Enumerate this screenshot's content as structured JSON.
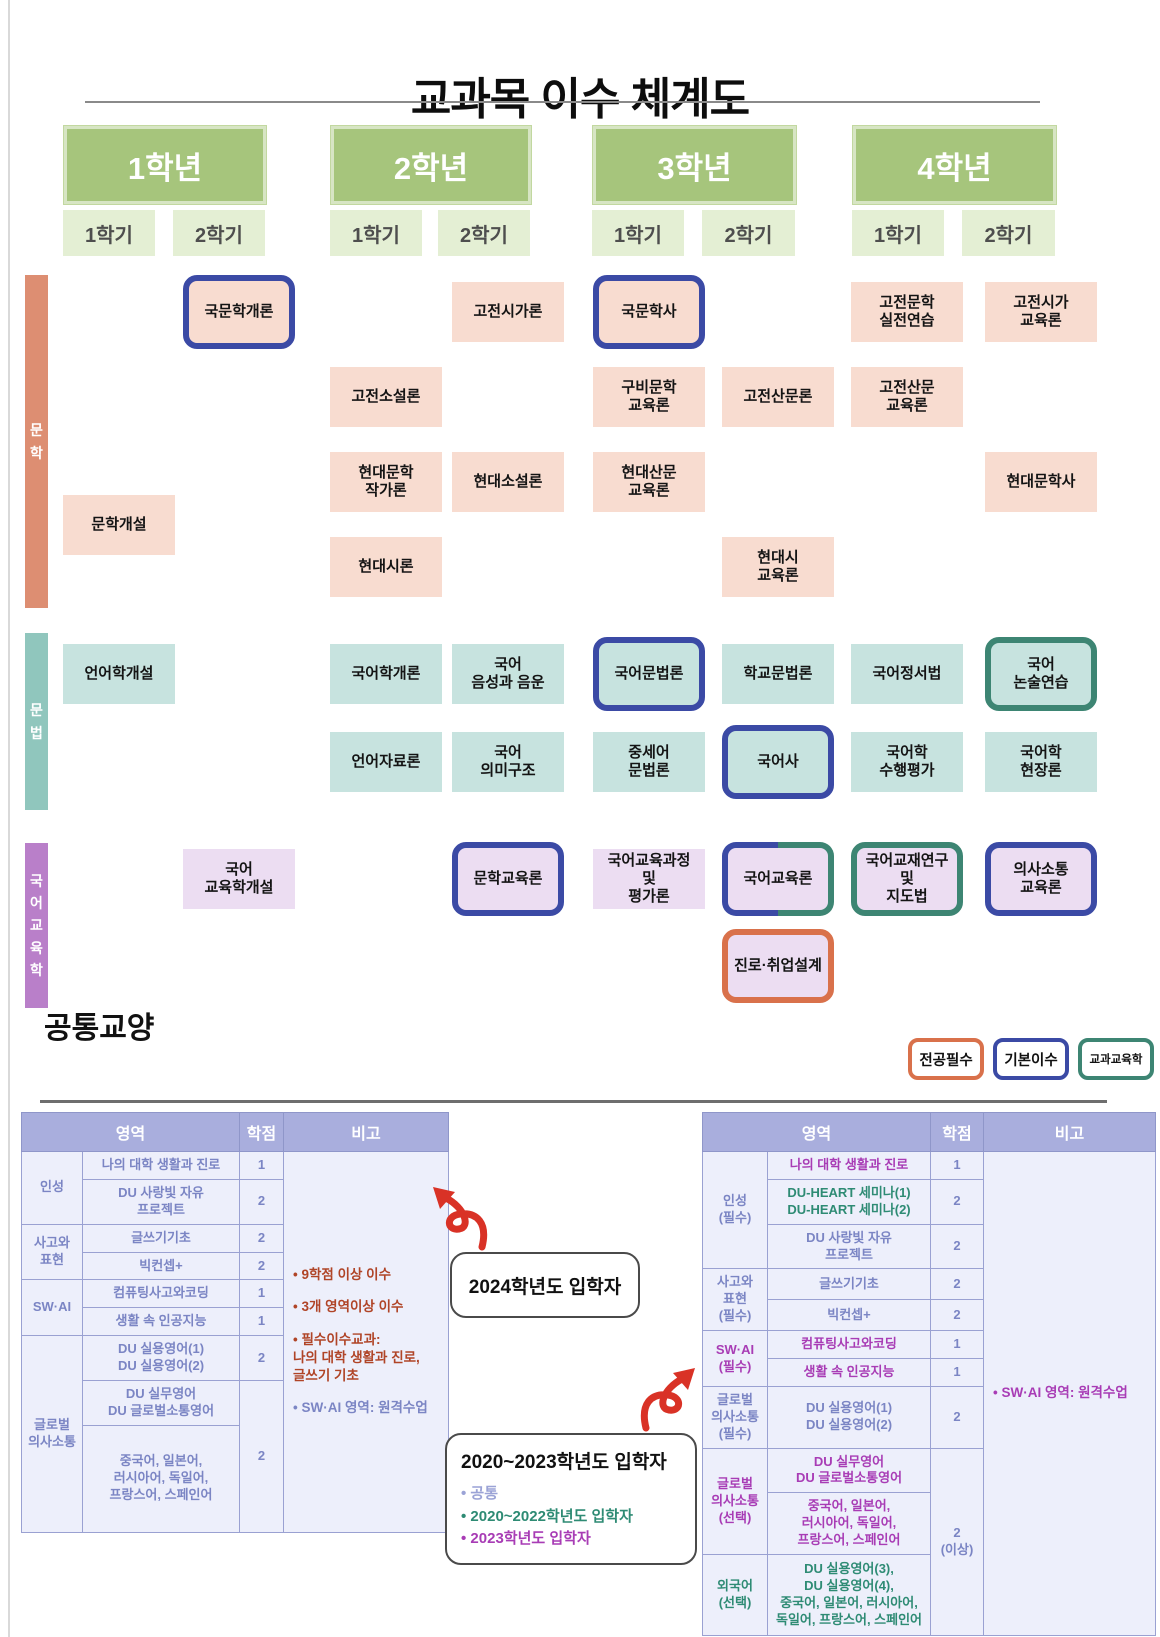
{
  "title": "교과목 이수 체계도",
  "years": [
    {
      "label": "1학년",
      "semesters": [
        "1학기",
        "2학기"
      ]
    },
    {
      "label": "2학년",
      "semesters": [
        "1학기",
        "2학기"
      ]
    },
    {
      "label": "3학년",
      "semesters": [
        "1학기",
        "2학기"
      ]
    },
    {
      "label": "4학년",
      "semesters": [
        "1학기",
        "2학기"
      ]
    }
  ],
  "sections": {
    "lit": {
      "label": "문\n학",
      "fill": "#f8dcd0",
      "bar": "#dd8e72"
    },
    "gram": {
      "label": "문\n법",
      "fill": "#c7e3df",
      "bar": "#90c6bd"
    },
    "edu": {
      "label": "국\n어\n교\n육\n학",
      "fill": "#ecddf2",
      "bar": "#b97fc9"
    }
  },
  "types": {
    "major": {
      "label": "전공필수",
      "color": "#d9714b"
    },
    "basic": {
      "label": "기본이수",
      "color": "#3b4aa5"
    },
    "subject": {
      "label": "교과교육학",
      "color": "#3d8573"
    }
  },
  "courses": [
    {
      "label": "국문학개론",
      "section": "lit",
      "col": 2,
      "row": 1,
      "type": "basic"
    },
    {
      "label": "고전시가론",
      "section": "lit",
      "col": 4,
      "row": 1,
      "type": "plain"
    },
    {
      "label": "국문학사",
      "section": "lit",
      "col": 5,
      "row": 1,
      "type": "basic"
    },
    {
      "label": "고전문학\n실전연습",
      "section": "lit",
      "col": 7,
      "row": 1,
      "type": "plain"
    },
    {
      "label": "고전시가\n교육론",
      "section": "lit",
      "col": 8,
      "row": 1,
      "type": "plain"
    },
    {
      "label": "고전소설론",
      "section": "lit",
      "col": 3,
      "row": 2,
      "type": "plain"
    },
    {
      "label": "구비문학\n교육론",
      "section": "lit",
      "col": 5,
      "row": 2,
      "type": "plain"
    },
    {
      "label": "고전산문론",
      "section": "lit",
      "col": 6,
      "row": 2,
      "type": "plain"
    },
    {
      "label": "고전산문\n교육론",
      "section": "lit",
      "col": 7,
      "row": 2,
      "type": "plain"
    },
    {
      "label": "현대문학\n작가론",
      "section": "lit",
      "col": 3,
      "row": 3,
      "type": "plain"
    },
    {
      "label": "현대소설론",
      "section": "lit",
      "col": 4,
      "row": 3,
      "type": "plain"
    },
    {
      "label": "현대산문\n교육론",
      "section": "lit",
      "col": 5,
      "row": 3,
      "type": "plain"
    },
    {
      "label": "현대문학사",
      "section": "lit",
      "col": 8,
      "row": 3,
      "type": "plain"
    },
    {
      "label": "문학개설",
      "section": "lit",
      "col": 1,
      "row": 3.5,
      "type": "plain"
    },
    {
      "label": "현대시론",
      "section": "lit",
      "col": 3,
      "row": 4,
      "type": "plain"
    },
    {
      "label": "현대시\n교육론",
      "section": "lit",
      "col": 6,
      "row": 4,
      "type": "plain"
    },
    {
      "label": "언어학개설",
      "section": "gram",
      "col": 1,
      "row": 1,
      "type": "plain"
    },
    {
      "label": "국어학개론",
      "section": "gram",
      "col": 3,
      "row": 1,
      "type": "plain"
    },
    {
      "label": "국어\n음성과 음운",
      "section": "gram",
      "col": 4,
      "row": 1,
      "type": "plain"
    },
    {
      "label": "국어문법론",
      "section": "gram",
      "col": 5,
      "row": 1,
      "type": "basic"
    },
    {
      "label": "학교문법론",
      "section": "gram",
      "col": 6,
      "row": 1,
      "type": "plain"
    },
    {
      "label": "국어정서법",
      "section": "gram",
      "col": 7,
      "row": 1,
      "type": "plain"
    },
    {
      "label": "국어\n논술연습",
      "section": "gram",
      "col": 8,
      "row": 1,
      "type": "subject"
    },
    {
      "label": "언어자료론",
      "section": "gram",
      "col": 3,
      "row": 2,
      "type": "plain"
    },
    {
      "label": "국어\n의미구조",
      "section": "gram",
      "col": 4,
      "row": 2,
      "type": "plain"
    },
    {
      "label": "중세어\n문법론",
      "section": "gram",
      "col": 5,
      "row": 2,
      "type": "plain"
    },
    {
      "label": "국어사",
      "section": "gram",
      "col": 6,
      "row": 2,
      "type": "basic"
    },
    {
      "label": "국어학\n수행평가",
      "section": "gram",
      "col": 7,
      "row": 2,
      "type": "plain"
    },
    {
      "label": "국어학\n현장론",
      "section": "gram",
      "col": 8,
      "row": 2,
      "type": "plain"
    },
    {
      "label": "국어\n교육학개설",
      "section": "edu",
      "col": 2,
      "row": 1,
      "type": "plain"
    },
    {
      "label": "문학교육론",
      "section": "edu",
      "col": 4,
      "row": 1,
      "type": "basic"
    },
    {
      "label": "국어교육과정\n및\n평가론",
      "section": "edu",
      "col": 5,
      "row": 1,
      "type": "plain"
    },
    {
      "label": "국어교육론",
      "section": "edu",
      "col": 6,
      "row": 1,
      "type": "split"
    },
    {
      "label": "국어교재연구\n및\n지도법",
      "section": "edu",
      "col": 7,
      "row": 1,
      "type": "subject"
    },
    {
      "label": "의사소통\n교육론",
      "section": "edu",
      "col": 8,
      "row": 1,
      "type": "basic"
    },
    {
      "label": "진로·취업설계",
      "section": "edu",
      "col": 6,
      "row": 2,
      "type": "major"
    }
  ],
  "common": {
    "title": "공통교양",
    "left_table": {
      "headers": [
        "영역",
        "학점",
        "비고"
      ],
      "rows": [
        {
          "cells": [
            {
              "t": "인성",
              "rs": 2
            },
            {
              "t": "나의 대학 생활과 진로"
            },
            {
              "t": "1"
            },
            {
              "rs": 9,
              "notes": [
                {
                  "t": "• 9학점 이상 이수",
                  "cls": "red"
                },
                {
                  "t": "• 3개 영역이상 이수",
                  "cls": "red"
                },
                {
                  "t": "• 필수이수교과:\n나의 대학 생활과 진로,\n글쓰기 기초",
                  "cls": "red"
                },
                {
                  "t": "• SW·AI 영역: 원격수업",
                  "cls": "lav"
                }
              ]
            }
          ]
        },
        {
          "cells": [
            {
              "t": "DU 사랑빛 자유\n프로젝트"
            },
            {
              "t": "2"
            }
          ]
        },
        {
          "cells": [
            {
              "t": "사고와\n표현",
              "rs": 2
            },
            {
              "t": "글쓰기기초"
            },
            {
              "t": "2"
            }
          ]
        },
        {
          "cells": [
            {
              "t": "빅컨셉+"
            },
            {
              "t": "2"
            }
          ]
        },
        {
          "cells": [
            {
              "t": "SW·AI",
              "rs": 2
            },
            {
              "t": "컴퓨팅사고와코딩"
            },
            {
              "t": "1"
            }
          ]
        },
        {
          "cells": [
            {
              "t": "생활 속 인공지능"
            },
            {
              "t": "1"
            }
          ]
        },
        {
          "cells": [
            {
              "t": "글로벌\n의사소통",
              "rs": 3
            },
            {
              "t": "DU 실용영어(1)\nDU 실용영어(2)"
            },
            {
              "t": "2"
            }
          ]
        },
        {
          "cells": [
            {
              "t": "DU 실무영어\nDU 글로벌소통영어"
            },
            {
              "t": "2",
              "rs": 2
            }
          ]
        },
        {
          "cells": [
            {
              "t": "중국어, 일본어,\n러시아어, 독일어,\n프랑스어, 스페인어",
              "h": 96
            }
          ]
        }
      ]
    },
    "right_table": {
      "headers": [
        "영역",
        "학점",
        "비고"
      ],
      "rows": [
        {
          "cells": [
            {
              "t": "인성\n(필수)",
              "rs": 3
            },
            {
              "t": "나의 대학 생활과 진로",
              "cls": "mag"
            },
            {
              "t": "1"
            },
            {
              "rs": 11,
              "notes": [
                {
                  "t": "• SW·AI 영역: 원격수업",
                  "cls": "mag"
                }
              ]
            }
          ]
        },
        {
          "cells": [
            {
              "t": "DU-HEART 세미나(1)\nDU-HEART 세미나(2)",
              "cls": "grn"
            },
            {
              "t": "2"
            }
          ]
        },
        {
          "cells": [
            {
              "t": "DU 사랑빛 자유\n프로젝트"
            },
            {
              "t": "2"
            }
          ]
        },
        {
          "cells": [
            {
              "t": "사고와\n표현\n(필수)",
              "rs": 2
            },
            {
              "t": "글쓰기기초"
            },
            {
              "t": "2"
            }
          ]
        },
        {
          "cells": [
            {
              "t": "빅컨셉+"
            },
            {
              "t": "2"
            }
          ]
        },
        {
          "cells": [
            {
              "t": "SW·AI\n(필수)",
              "rs": 2,
              "cls": "mag"
            },
            {
              "t": "컴퓨팅사고와코딩",
              "cls": "mag"
            },
            {
              "t": "1"
            }
          ]
        },
        {
          "cells": [
            {
              "t": "생활 속 인공지능",
              "cls": "mag"
            },
            {
              "t": "1"
            }
          ]
        },
        {
          "cells": [
            {
              "t": "글로벌\n의사소통\n(필수)"
            },
            {
              "t": "DU 실용영어(1)\nDU 실용영어(2)"
            },
            {
              "t": "2"
            }
          ]
        },
        {
          "cells": [
            {
              "t": "글로벌\n의사소통\n(선택)",
              "rs": 2,
              "cls": "mag"
            },
            {
              "t": "DU 실무영어\nDU 글로벌소통영어",
              "cls": "mag"
            },
            {
              "t": "2\n(이상)",
              "rs": 3
            }
          ]
        },
        {
          "cells": [
            {
              "t": "중국어, 일본어,\n러시아어, 독일어,\n프랑스어, 스페인어",
              "cls": "mag"
            }
          ]
        },
        {
          "cells": [
            {
              "t": "외국어\n(선택)",
              "cls": "grn"
            },
            {
              "t": "DU 실용영어(3),\nDU 실용영어(4),\n중국어, 일본어, 러시아어,\n독일어, 프랑스어, 스페인어",
              "cls": "grn",
              "h": 70
            }
          ]
        }
      ]
    },
    "callouts": [
      {
        "title": "2024학년도 입학자",
        "bullets": []
      },
      {
        "title": "2020~2023학년도 입학자",
        "bullets": [
          {
            "t": "• 공통",
            "cls": "lav"
          },
          {
            "t": "• 2020~2022학년도 입학자",
            "cls": "grn"
          },
          {
            "t": "• 2023학년도 입학자",
            "cls": "mag"
          }
        ]
      }
    ]
  }
}
